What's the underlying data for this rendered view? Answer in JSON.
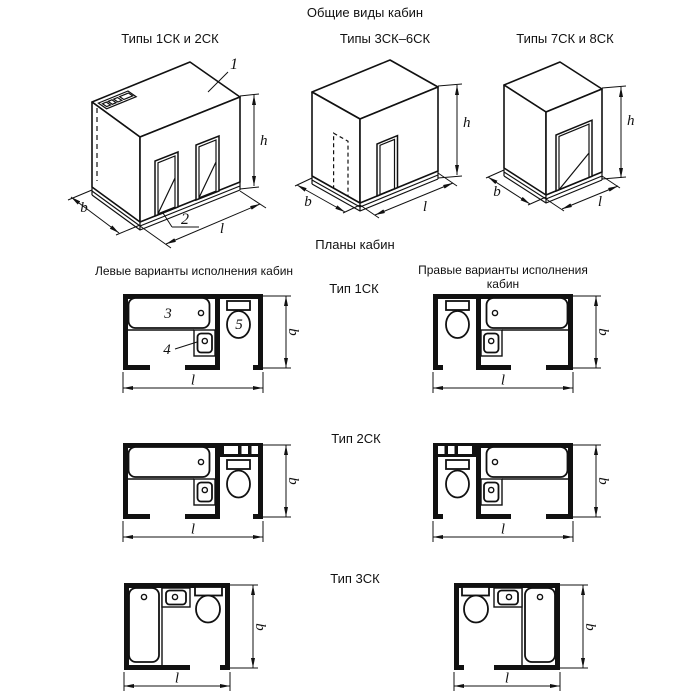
{
  "titles": {
    "main": "Общие виды кабин",
    "plans": "Планы кабин",
    "left_column": "Левые варианты исполнения кабин",
    "right_column": "Правые варианты исполнения кабин"
  },
  "general_views": {
    "label_1": "Типы 1СК и 2СК",
    "label_2": "Типы 3СК–6СК",
    "label_3": "Типы 7СК и 8СК"
  },
  "plan_rows": {
    "type_1sk": "Тип 1СК",
    "type_2sk": "Тип 2СК",
    "type_3sk": "Тип 3СК"
  },
  "dimension_labels": {
    "height": "h",
    "depth": "b",
    "length": "l"
  },
  "callouts": {
    "c1": "1",
    "c2": "2",
    "c3": "3",
    "c4": "4",
    "c5": "5"
  },
  "colors": {
    "ink": "#111111",
    "background": "#ffffff"
  }
}
